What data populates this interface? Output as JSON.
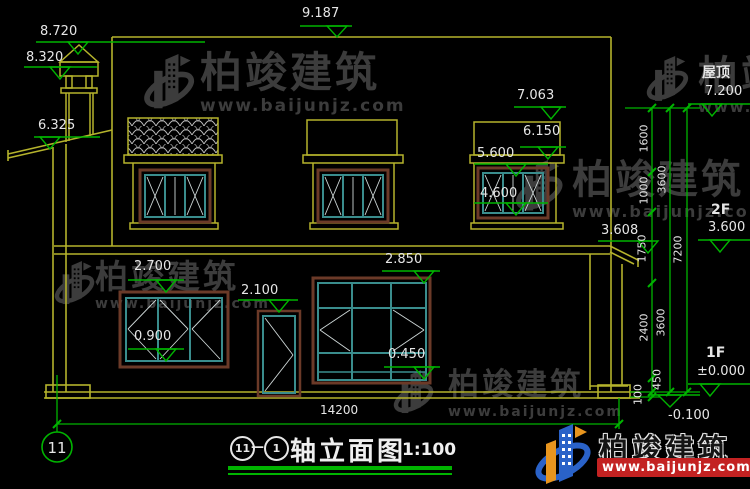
{
  "drawing": {
    "levels": {
      "chimney_top": "8.720",
      "chimney_cap": "8.320",
      "parapet_top": "9.187",
      "left_eave": "6.325",
      "canopy_top": "7.063",
      "canopy_bottom": "6.150",
      "win2f_head": "5.600",
      "win2f_sill": "4.600",
      "right_eave": "3.608",
      "win1f_head": "2.700",
      "win1f_sill": "0.900",
      "door_head": "2.100",
      "mainwin_head": "2.850",
      "mainwin_sill": "0.450"
    },
    "right_levels": [
      {
        "label": "屋顶",
        "value": "7.200"
      },
      {
        "label": "2F",
        "value": "3.600"
      },
      {
        "label": "1F",
        "value": "±0.000"
      },
      {
        "label": "",
        "value": "-0.100"
      }
    ],
    "chain": {
      "c1": [
        "1600",
        "1000",
        "1750",
        "2400",
        "450",
        "100"
      ],
      "c2": [
        "3600",
        "3600"
      ],
      "c3": [
        "7200"
      ]
    },
    "total_width": "14200",
    "axis": "11"
  },
  "title": {
    "axis_from": "11",
    "separator": "—",
    "axis_to": "1",
    "name": "轴立面图",
    "scale": "1:100"
  },
  "watermark": {
    "brand": "柏竣建筑",
    "url": "www.baijunjz.com"
  },
  "logo": {
    "brand": "柏竣建筑",
    "url": "www.baijunjz.com"
  },
  "colors": {
    "wall_yellow": "#b5b32c",
    "dim_green": "#00b400",
    "text_white": "#e6e6e6",
    "window_teal": "#3a8d8d",
    "frame_brown": "#6b3a28",
    "watermark_gray": "#3c3c3c",
    "logo_red": "#c32222",
    "logo_blue": "#2a62c8",
    "logo_orange": "#e8951e"
  }
}
